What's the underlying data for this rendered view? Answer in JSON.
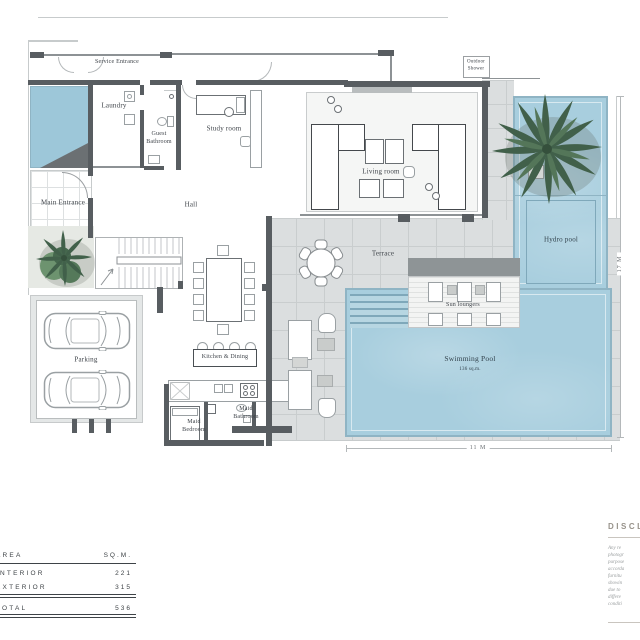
{
  "plan": {
    "rooms": {
      "service_entrance": "Service Entrance",
      "laundry": "Laundry",
      "guest_bathroom": "Guest\nBathroom",
      "study_room": "Study room",
      "living_room": "Living room",
      "main_entrance": "Main Entrance",
      "hall": "Hall",
      "kitchen_dining": "Kitchen & Dining",
      "terrace": "Terrace",
      "parking": "Parking",
      "maid_bedroom": "Maid\nBedroom",
      "maid_bathroom": "Maid\nBathroom",
      "sun_loungers": "Sun loungers",
      "swimming_pool": "Swimming Pool",
      "swimming_pool_area": "136 sq.m.",
      "hydro_pool": "Hydro pool",
      "outdoor_shower": "Outdoor\nShower"
    },
    "dimensions": {
      "width_label": "11 M",
      "height_label": "17 M"
    }
  },
  "area_table": {
    "header": {
      "label": "AREA",
      "unit": "SQ.M."
    },
    "rows": [
      {
        "label": "INTERIOR",
        "value": "221"
      },
      {
        "label": "EXTERIOR",
        "value": "315"
      },
      {
        "label": "TOTAL",
        "value": "536"
      }
    ]
  },
  "disclaimer": {
    "title": "DISCLAIMER",
    "lines": [
      "Any re",
      "photogr",
      "purpose",
      "accorda",
      "furnitu",
      "showin",
      "due to",
      "differe",
      "conditi"
    ]
  },
  "colors": {
    "wall": "#585d61",
    "pool": "#a8cede",
    "pool_edge": "#8fb4c4",
    "water": "#9dc7d9",
    "terrace": "#dbdedf",
    "tile_line": "#c9cdce",
    "green_dark": "#41604a",
    "green_mid": "#547659",
    "text": "#3f444a"
  }
}
